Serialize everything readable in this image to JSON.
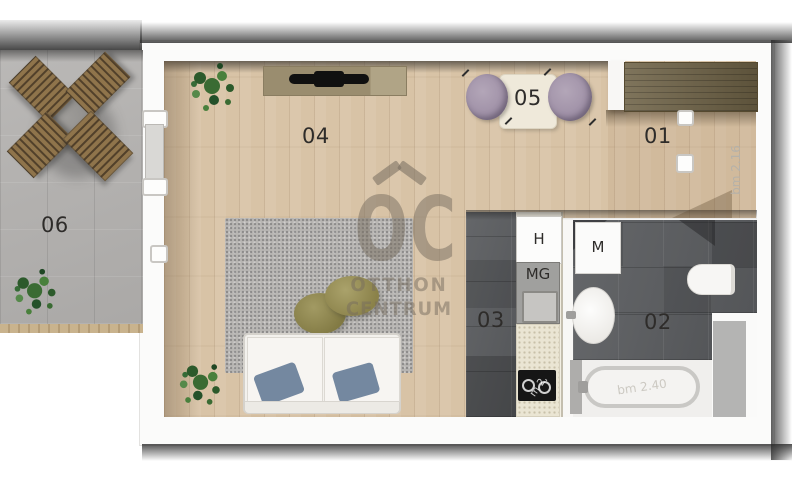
{
  "plan": {
    "title": "studio-apartment-floor-plan",
    "rooms": [
      {
        "number": "01",
        "name": "entry-hall"
      },
      {
        "number": "02",
        "name": "bathroom"
      },
      {
        "number": "03",
        "name": "kitchen-hall"
      },
      {
        "number": "04",
        "name": "living-room"
      },
      {
        "number": "05",
        "name": "dining-nook"
      },
      {
        "number": "06",
        "name": "terrace"
      }
    ],
    "appliances": {
      "fridge": "H",
      "dishwasher": "MG",
      "washing_machine": "M"
    },
    "dimensions": {
      "entry_ceiling_height": "bm 2.16",
      "bath_ceiling_height": "bm 2.40",
      "cooktop_partial": "m 2,"
    },
    "watermark": {
      "logo": "OC",
      "line1": "OTTHON",
      "line2": "CENTRUM"
    },
    "colors": {
      "wood_floor": "#d8c3a6",
      "dark_tile": "#5b5d60",
      "terrace_tile": "#b5b3b1",
      "dining_chair": "#a495aa",
      "pouf": "#8e864c",
      "pillow": "#7488a0",
      "kitchen_counter": "#eae5d3",
      "wardrobe": "#6d6145",
      "bath_mat": "#b4b4b3",
      "plant": "#3a6b33",
      "watermark": "#766c5e"
    }
  }
}
